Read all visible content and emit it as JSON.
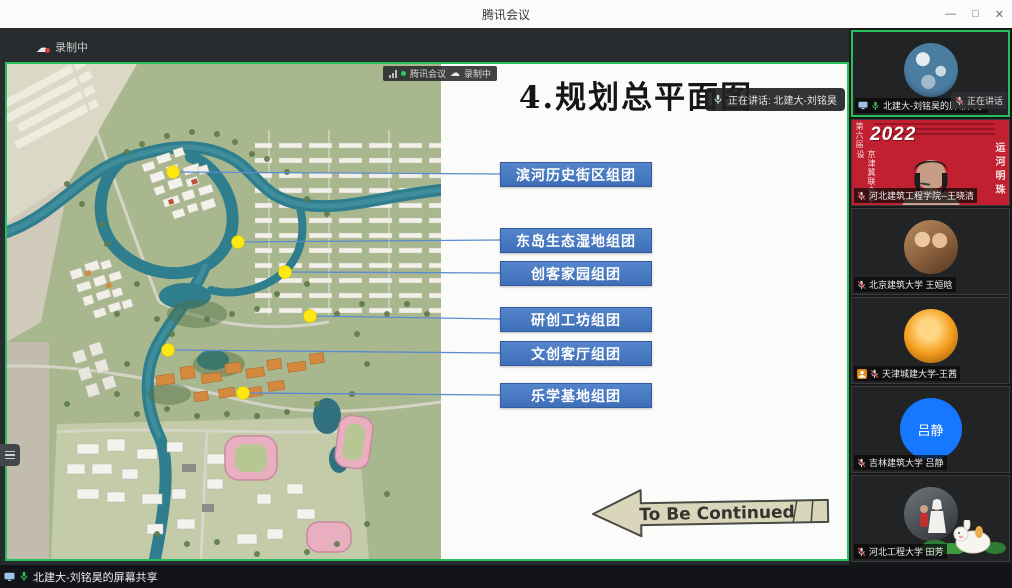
{
  "window": {
    "title": "腾讯会议",
    "minimize": "—",
    "maximize": "□",
    "close": "✕"
  },
  "recording": {
    "label": "录制中"
  },
  "share": {
    "badge": {
      "app": "腾讯会议",
      "recording": "录制中"
    },
    "speaking": "正在讲话: 北建大-刘铭昊",
    "slide": {
      "title": "4.规划总平面图",
      "labels": [
        "滨河历史街区组团",
        "东岛生态湿地组团",
        "创客家园组团",
        "研创工坊组团",
        "文创客厅组团",
        "乐学基地组团"
      ],
      "continued": "To Be Continued"
    }
  },
  "statusbar": {
    "share_label": "北建大-刘铭昊的屏幕共享"
  },
  "sidebar": {
    "participants": [
      {
        "label": "北建大-刘铭昊的屏幕共享",
        "overlay": "正在讲话",
        "speaking": true
      },
      {
        "label": "河北建筑工程学院--王晓清",
        "banner": {
          "year": "2022",
          "corner": "第六届",
          "left_text": "京津冀联合毕设",
          "right_text": "运河明珠"
        }
      },
      {
        "label": "北京建筑大学 王姮晗"
      },
      {
        "label": "天津城建大学-王茜"
      },
      {
        "label": "吉林建筑大学 吕静",
        "avatar_text": "吕静"
      },
      {
        "label": "河北工程大学 田芳"
      }
    ]
  },
  "colors": {
    "accent_green": "#26c05e",
    "label_blue": "#4377c5",
    "line_blue": "#5b8bd0",
    "dot_yellow": "#ffe812",
    "banner_red": "#c0202f",
    "mic_green": "#35c763",
    "mute_red": "#e14747"
  }
}
